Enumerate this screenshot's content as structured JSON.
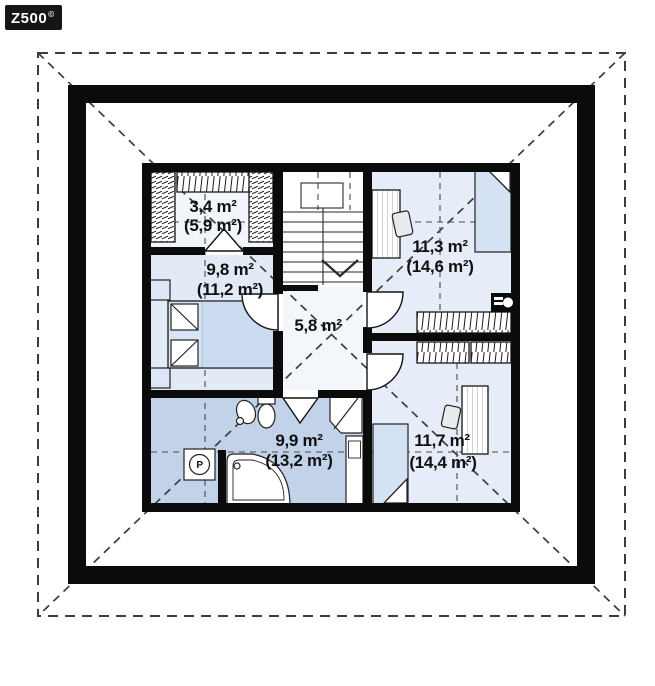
{
  "logo": {
    "text": "Z500",
    "sup": "©"
  },
  "rooms": [
    {
      "name": "wardrobe",
      "area": "3,4 m²",
      "total": "(5,9 m²)"
    },
    {
      "name": "bedroom-left",
      "area": "9,8 m²",
      "total": "(11,2 m²)"
    },
    {
      "name": "bedroom-top-right",
      "area": "11,3 m²",
      "total": "(14,6 m²)"
    },
    {
      "name": "hall",
      "area": "5,8 m²",
      "total": ""
    },
    {
      "name": "bathroom",
      "area": "9,9 m²",
      "total": "(13,2 m²)"
    },
    {
      "name": "bedroom-bottom-right",
      "area": "11,7 m²",
      "total": "(14,4 m²)"
    }
  ],
  "symbols": {
    "washing_machine": "P"
  },
  "colors": {
    "wall": "#0b0b0b",
    "room_fill": "#e6edf8",
    "light_fill": "#f3f6fb",
    "bathroom_fill": "#c2d3e9",
    "bed_fill": "#d4e2f3",
    "dash_line": "#3c3c3c"
  }
}
